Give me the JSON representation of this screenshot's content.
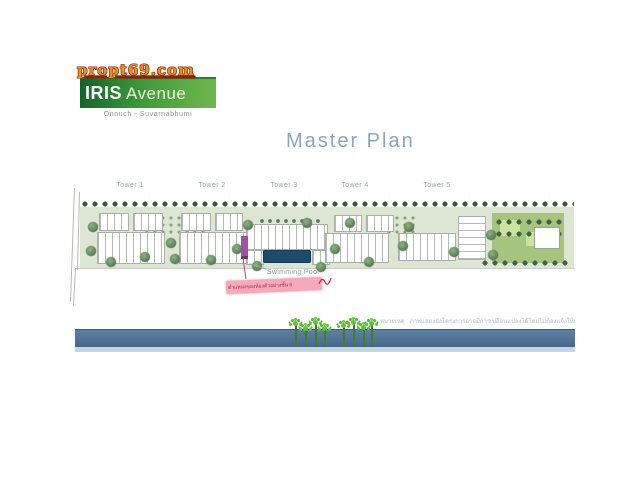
{
  "watermark": {
    "text": "propt69.com",
    "color": "#ef8c1d"
  },
  "logo": {
    "brand": "IRIS",
    "brand_suffix": "Avenue",
    "subtitle": "Onnuch - Suvarnabhumi",
    "green": "#3d9a3b"
  },
  "title": "Master Plan",
  "site_plan": {
    "tower_labels": [
      "Tower 1",
      "Tower 2",
      "Tower 3",
      "Tower 4",
      "Tower 5"
    ],
    "pool_label": "Swimming Pool",
    "annotation_text": "ตำแหน่งของห้องตัวอย่างชั้น 6",
    "disclaimer": "หมายเหตุ : ภาพแสดงผังโครงการอาจมีการเปลี่ยนแปลงได้โดยไม่ต้องแจ้งให้ทราบล่วงหน้า"
  },
  "colors": {
    "band_blue": "#4e7290",
    "pool_blue": "#1e4a6b",
    "highlight_pink": "#f7a9bc",
    "marker_purple": "#a14fa8",
    "palm_green": "#5ec437",
    "ground_green": "#dde6d3"
  }
}
